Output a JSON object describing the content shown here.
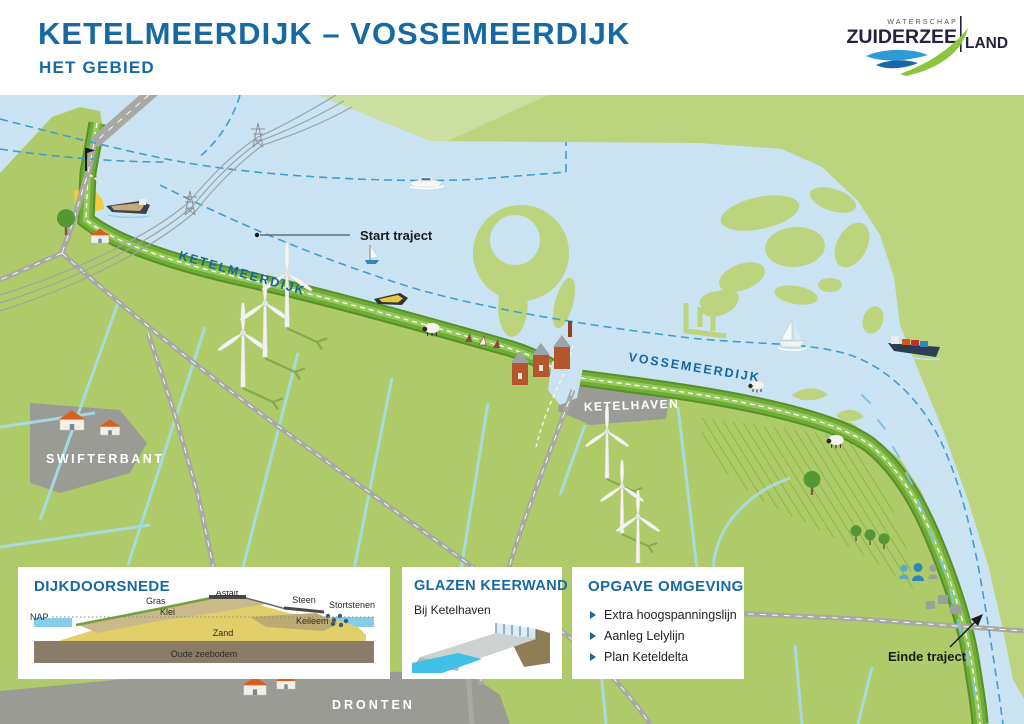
{
  "header": {
    "title": "KETELMEERDIJK – VOSSEMEERDIJK",
    "subtitle": "HET GEBIED"
  },
  "logo": {
    "top": "WATERSCHAP",
    "name_left": "ZUIDERZEE",
    "name_right": "LAND"
  },
  "map": {
    "labels": {
      "ketelmeerdijk": "KETELMEERDIJK",
      "vossemeerdijk": "VOSSEMEERDIJK",
      "ketelhaven": "KETELHAVEN",
      "swifterbant": "SWIFTERBANT",
      "dronten": "DRONTEN",
      "start_traject": "Start traject",
      "einde_traject": "Einde traject"
    }
  },
  "panels": {
    "dijkdoorsnede": {
      "title": "DIJKDOORSNEDE",
      "labels": {
        "nap": "NAP",
        "gras": "Gras",
        "klei": "Klei",
        "asfalt": "Asfalt",
        "steen": "Steen",
        "stortstenen": "Stortstenen",
        "keileem": "Keileem",
        "zand": "Zand",
        "oude_zeebodem": "Oude zeebodem"
      }
    },
    "glazen_keerwand": {
      "title": "GLAZEN KEERWAND",
      "subtitle": "Bij Ketelhaven"
    },
    "opgave_omgeving": {
      "title": "OPGAVE OMGEVING",
      "items": [
        "Extra hoogspanningslijn",
        "Aanleg Lelylijn",
        "Plan Keteldelta"
      ]
    }
  },
  "colors": {
    "title_blue": "#1769A3",
    "water": "#C9E3F2",
    "polder_green": "#AFCB69",
    "far_green": "#BCD47E",
    "dike_green": "#6FAD36",
    "urban_grey": "#9B9B96",
    "route_blue": "#3E9ED2"
  }
}
